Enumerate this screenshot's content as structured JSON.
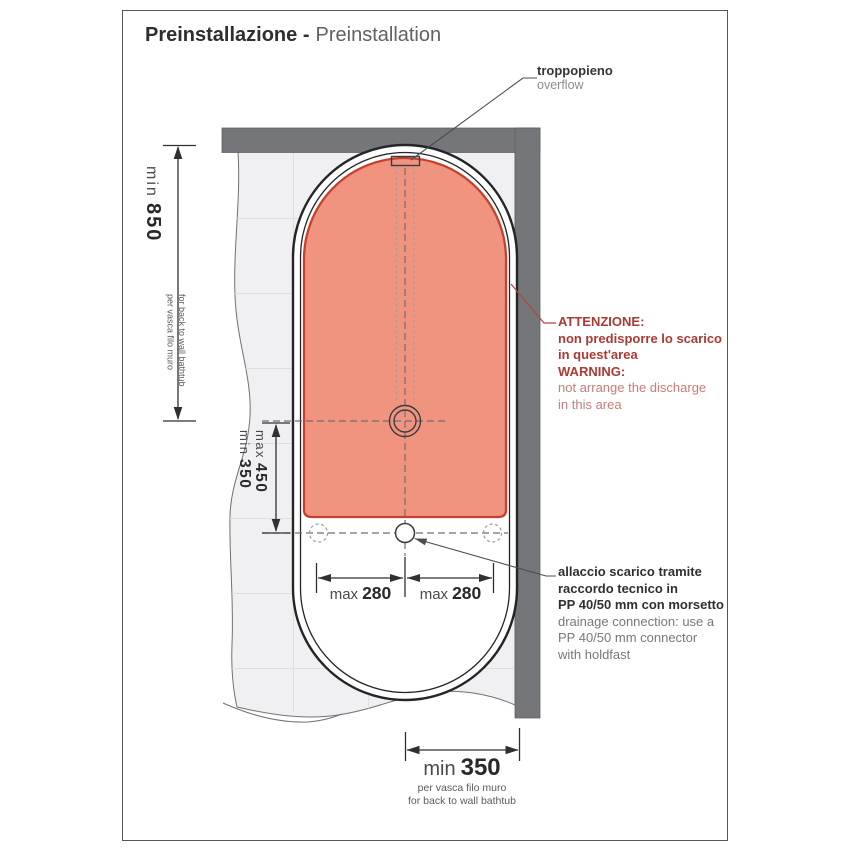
{
  "title": {
    "it": "Preinstallazione -",
    "en": "Preinstallation"
  },
  "callouts": {
    "overflow": {
      "it": "troppopieno",
      "en": "overflow"
    },
    "warning": {
      "title_it": "ATTENZIONE:",
      "body_it_1": "non predisporre lo scarico",
      "body_it_2": "in quest'area",
      "title_en": "WARNING:",
      "body_en_1": "not arrange the discharge",
      "body_en_2": "in this area"
    },
    "drain_connection": {
      "it_1": "allaccio scarico tramite",
      "it_2": "raccordo tecnico in",
      "it_3": "PP 40/50 mm con morsetto",
      "en_1": "drainage connection: use a",
      "en_2": "PP 40/50 mm connector",
      "en_3": "with holdfast"
    }
  },
  "dimensions": {
    "back_wall_distance": {
      "label": "min",
      "value": "850",
      "note_it": "per vasca filo muro",
      "note_en": "for back to wall bathtub"
    },
    "drain_zone_vertical": {
      "min_label": "min",
      "min_value": "350",
      "max_label": "max",
      "max_value": "450"
    },
    "drain_offset_left": {
      "label": "max",
      "value": "280"
    },
    "drain_offset_right": {
      "label": "max",
      "value": "280"
    },
    "side_wall_distance": {
      "label": "min",
      "value": "350",
      "note_it": "per vasca filo muro",
      "note_en": "for back to wall bathtub"
    }
  },
  "colors": {
    "warning_zone_fill": "#f0947f",
    "warning_zone_border": "#c7402f",
    "warning_text": "#ab3a33",
    "wall": "#75767a"
  }
}
